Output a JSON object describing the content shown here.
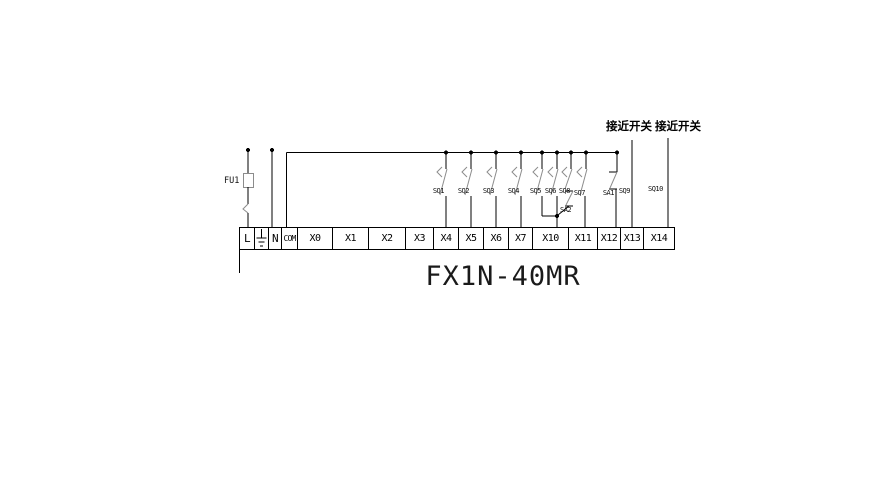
{
  "title": "FX1N-40MR",
  "power": {
    "fuse_label": "FU1"
  },
  "terminal_strip": {
    "labels": [
      "L",
      "N",
      "COM",
      "X0",
      "X1",
      "X2",
      "X3",
      "X4",
      "X5",
      "X6",
      "X7",
      "X10",
      "X11",
      "X12",
      "X13",
      "X14"
    ]
  },
  "input_switches": {
    "sq1": "SQ1",
    "sq2": "SQ2",
    "sq3": "SQ3",
    "sq4": "SQ4",
    "sq5": "SQ5",
    "sq6": "SQ6",
    "sq7": "SQ7",
    "sq8": "SQ8",
    "sq9": "SQ9",
    "sq10": "SQ10",
    "sa1": "SA1",
    "sa2": "SA2"
  },
  "annotations": {
    "proximity_switch_1": "接近开关",
    "proximity_switch_2": "接近开关"
  },
  "colors": {
    "wire": "#000000",
    "component_gray": "#8c8c8c"
  }
}
